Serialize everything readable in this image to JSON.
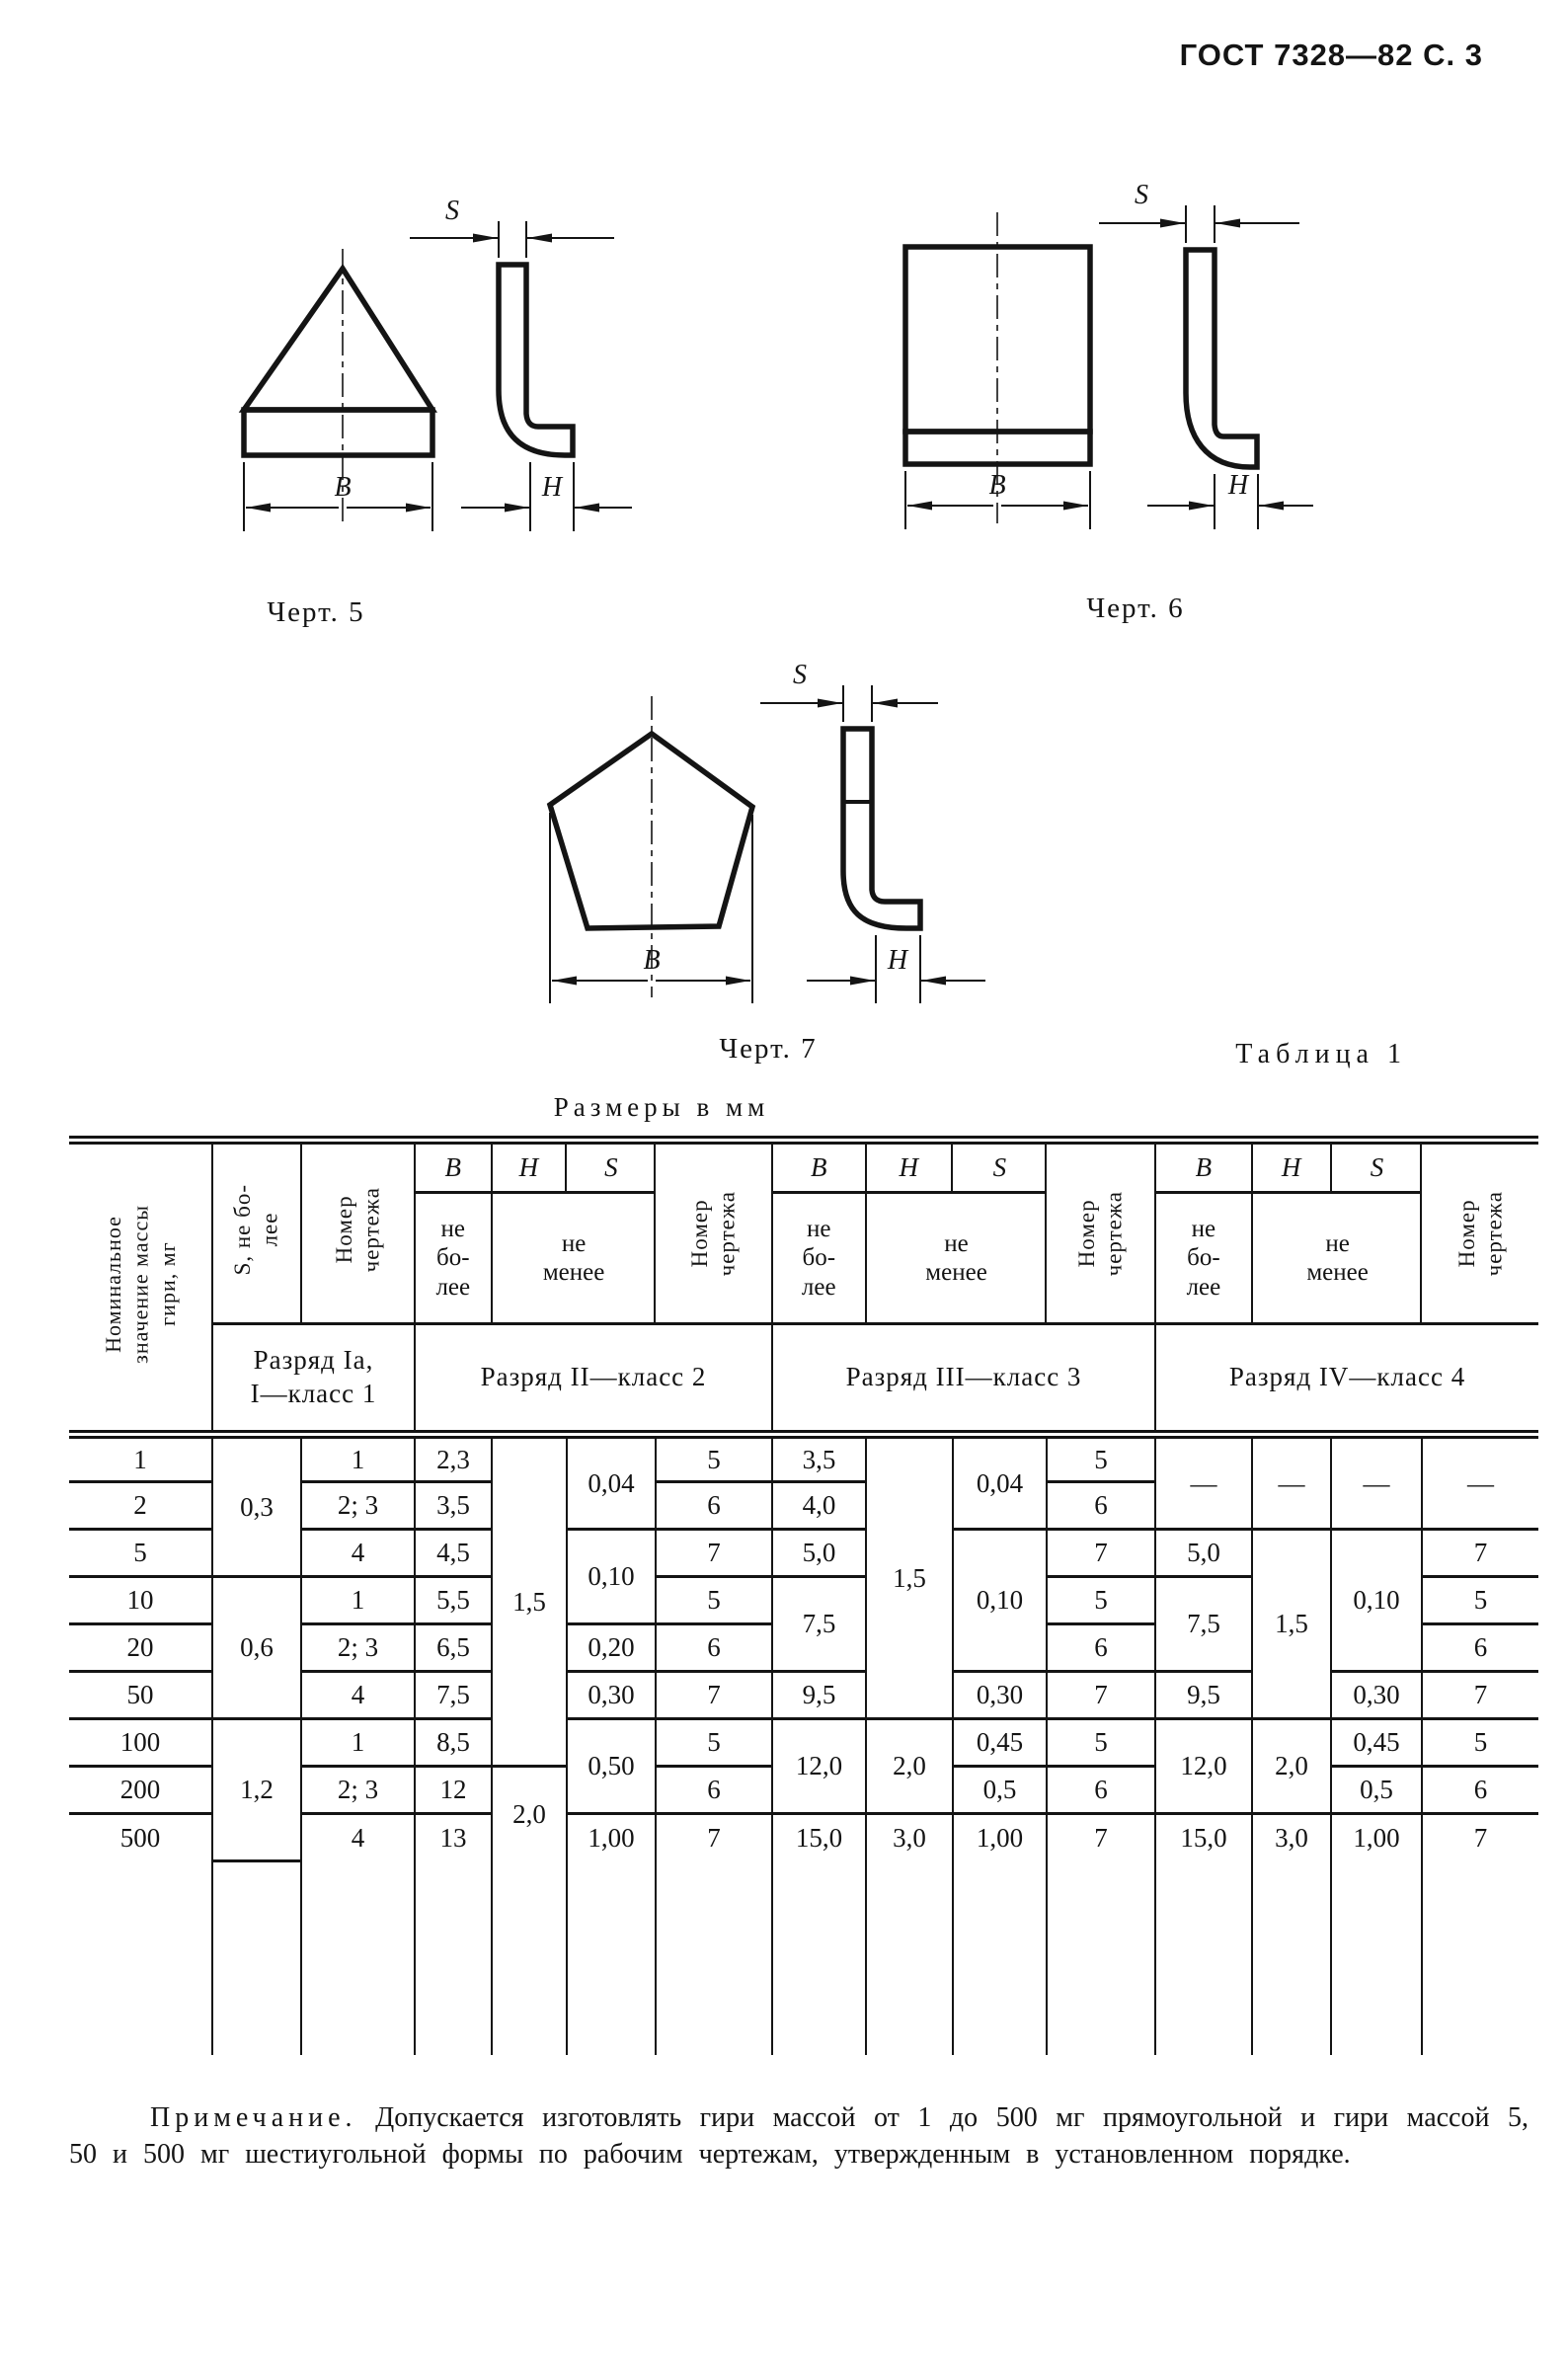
{
  "page": {
    "doc_ref": "ГОСТ 7328—82 С. 3"
  },
  "figures": {
    "fig5": {
      "caption": "Черт. 5",
      "labels": {
        "b": "B",
        "h": "H",
        "s": "S"
      }
    },
    "fig6": {
      "caption": "Черт. 6",
      "labels": {
        "b": "B",
        "h": "H",
        "s": "S"
      }
    },
    "fig7": {
      "caption": "Черт. 7",
      "labels": {
        "b": "B",
        "h": "H",
        "s": "S"
      }
    }
  },
  "table": {
    "label": "Таблица 1",
    "units_note": "Размеры в мм",
    "header": {
      "mass": "Номинальное\nзначение массы\nгири, мг",
      "group1": {
        "s": "S, не бо-\nлее",
        "nomer": "Номер\nчертежа",
        "razryad": "Разряд Iа,\nI—класс 1"
      },
      "group2": {
        "b": "B",
        "h": "H",
        "s": "S",
        "ne_bolee": "не\nбо-\nлее",
        "ne_menee": "не\nменее",
        "nomer": "Номер\nчертежа",
        "razryad": "Разряд II—класс 2"
      },
      "group3": {
        "b": "B",
        "h": "H",
        "s": "S",
        "ne_bolee": "не\nбо-\nлее",
        "ne_menee": "не\nменее",
        "nomer": "Номер\nчертежа",
        "razryad": "Разряд III—класс 3"
      },
      "group4": {
        "b": "B",
        "h": "H",
        "s": "S",
        "ne_bolee": "не\nбо-\nлее",
        "ne_menee": "не\nменее",
        "nomer": "Номер\nчертежа",
        "razryad": "Разряд IV—класс 4"
      }
    },
    "body": {
      "r0": [
        "1",
        "0,3",
        "1",
        "2,3",
        "1,5",
        "0,04",
        "5",
        "3,5",
        "1,5",
        "0,04",
        "5",
        "—",
        "—",
        "—",
        "—"
      ],
      "r1": [
        "2",
        "2; 3",
        "3,5",
        "6",
        "4,0",
        "6"
      ],
      "r2": [
        "5",
        "4",
        "4,5",
        "0,10",
        "7",
        "5,0",
        "0,10",
        "7",
        "5,0",
        "1,5",
        "0,10",
        "7"
      ],
      "r3": [
        "10",
        "0,6",
        "1",
        "5,5",
        "5",
        "7,5",
        "5",
        "7,5",
        "5"
      ],
      "r4": [
        "20",
        "2; 3",
        "6,5",
        "0,20",
        "6",
        "6",
        "6"
      ],
      "r5": [
        "50",
        "4",
        "7,5",
        "0,30",
        "7",
        "9,5",
        "0,30",
        "7",
        "9,5",
        "0,30",
        "7"
      ],
      "r6": [
        "100",
        "1,2",
        "1",
        "8,5",
        "0,50",
        "5",
        "12,0",
        "2,0",
        "0,45",
        "5",
        "12,0",
        "2,0",
        "0,45",
        "5"
      ],
      "r7": [
        "200",
        "2; 3",
        "12",
        "2,0",
        "6",
        "0,5",
        "6",
        "0,5",
        "6"
      ],
      "r8": [
        "500",
        "4",
        "13",
        "1,00",
        "7",
        "15,0",
        "3,0",
        "1,00",
        "7",
        "15,0",
        "3,0",
        "1,00",
        "7"
      ]
    }
  },
  "note": {
    "label": "Примечание.",
    "text": "Допускается изготовлять гири массой от 1 до 500 мг прямоугольной и гири массой 5, 50 и 500 мг шестиугольной формы по рабочим чертежам, утвержденным в установленном порядке."
  }
}
